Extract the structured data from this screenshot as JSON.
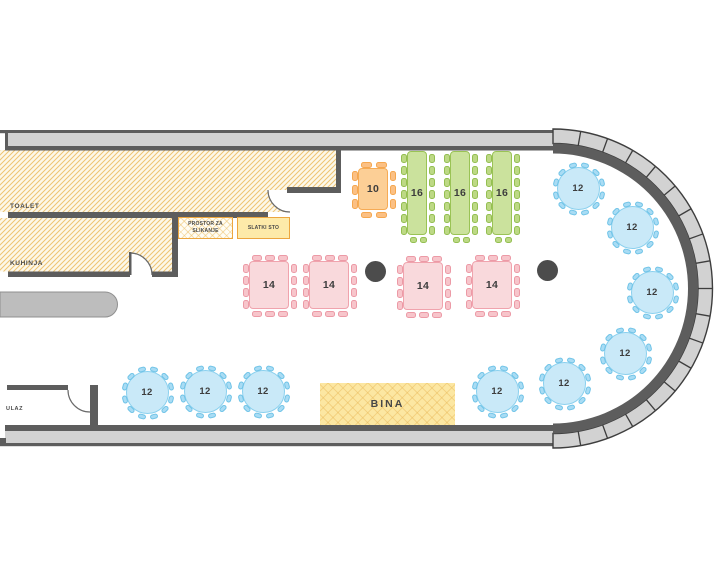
{
  "plan": {
    "rooms": {
      "toalet": {
        "label": "TOALET"
      },
      "kuhinja": {
        "label": "KUHINJA"
      },
      "ulaz": {
        "label": "ULAZ"
      }
    },
    "areas": {
      "photo": {
        "label_line1": "PROSTOR ZA",
        "label_line2": "SLIKANJE"
      },
      "sweet": {
        "label": "SLATKI STO"
      },
      "stage": {
        "label": "BINA"
      }
    },
    "tables": [
      {
        "id": "round-blue",
        "shape": "round",
        "seats": "12",
        "count": 9,
        "color": "blue",
        "positions": [
          [
            578,
            188
          ],
          [
            632,
            227
          ],
          [
            652,
            292
          ],
          [
            625,
            353
          ],
          [
            564,
            383
          ],
          [
            497,
            391
          ],
          [
            263,
            391
          ],
          [
            205,
            391
          ],
          [
            147,
            392
          ]
        ]
      },
      {
        "id": "square-pink",
        "shape": "rect",
        "seats": "14",
        "count": 4,
        "color": "pink",
        "w": 40,
        "h": 48,
        "chairs": {
          "top": 3,
          "bottom": 3,
          "left": 4,
          "right": 4
        },
        "positions": [
          [
            269,
            285
          ],
          [
            329,
            285
          ],
          [
            423,
            286
          ],
          [
            492,
            285
          ]
        ]
      },
      {
        "id": "long-green",
        "shape": "rect",
        "seats": "16",
        "count": 3,
        "color": "green",
        "w": 20,
        "h": 84,
        "chairs": {
          "top": 0,
          "bottom": 2,
          "left": 7,
          "right": 7
        },
        "positions": [
          [
            417,
            193
          ],
          [
            460,
            193
          ],
          [
            502,
            193
          ]
        ]
      },
      {
        "id": "rect-orange",
        "shape": "rect",
        "seats": "10",
        "count": 1,
        "color": "orange",
        "w": 30,
        "h": 42,
        "chairs": {
          "top": 2,
          "bottom": 2,
          "left": 3,
          "right": 3
        },
        "positions": [
          [
            373,
            189
          ]
        ]
      }
    ],
    "pillars": [
      [
        375,
        271
      ],
      [
        547,
        270
      ]
    ],
    "colors": {
      "wall_dark": "#5d5d5d",
      "wall_light": "#d2d2d2",
      "wall_outline": "#3e3e3e",
      "hatch_line": "#eec473",
      "hatch_bg": "#fdf8ea",
      "accent_border": "#eca63f",
      "stage_fill": "#fce7a2",
      "sweet_fill": "#fdeaa9",
      "blue_fill": "#c9e9f8",
      "blue_stroke": "#8ad0ee",
      "blue_chair": "#a9dcf4",
      "blue_chair_stroke": "#6fc3e7",
      "pink_fill": "#f9d9dc",
      "pink_stroke": "#f0a3ad",
      "pink_chair": "#f7c5cb",
      "pink_chair_stroke": "#ec9aa6",
      "green_fill": "#cbe29d",
      "green_stroke": "#9ac355",
      "green_chair": "#bdd985",
      "green_chair_stroke": "#94bf51",
      "orange_fill": "#fccf96",
      "orange_stroke": "#f6ab55",
      "orange_chair": "#fbc084",
      "orange_chair_stroke": "#f5a74f",
      "pillar": "#4c4c4c",
      "text": "#3d3d3d"
    }
  }
}
